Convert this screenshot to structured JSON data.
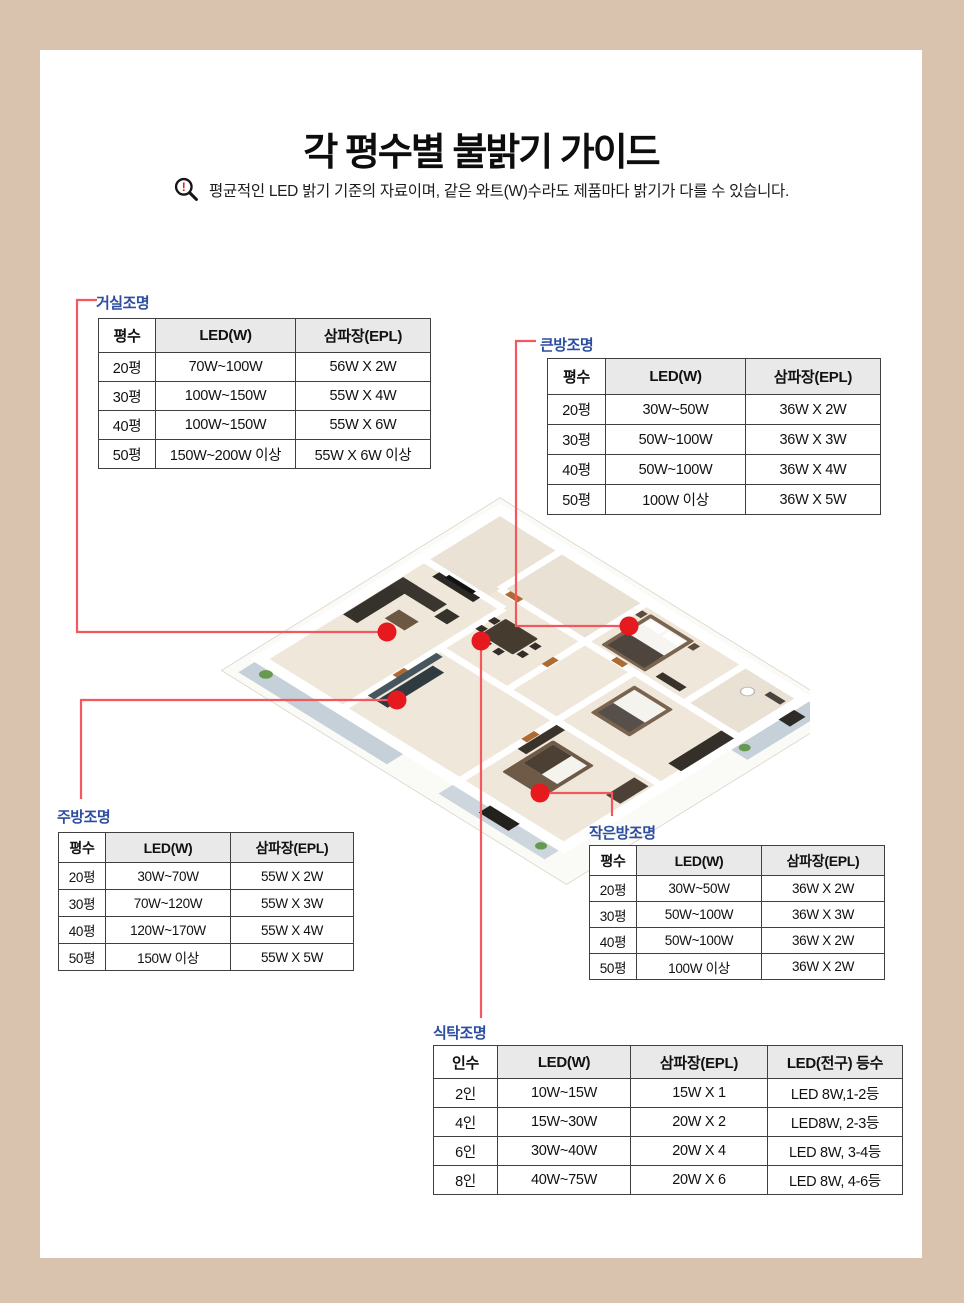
{
  "header": {
    "title": "각 평수별 불밝기 가이드",
    "notice": "평균적인 LED 밝기 기준의 자료이며, 같은 와트(W)수라도 제품마다 밝기가 다를 수 있습니다."
  },
  "colors": {
    "frame_beige": "#d9c3ae",
    "label_blue": "#2c4da0",
    "connector_red": "#f2595e",
    "dot_red": "#e6191f",
    "table_header_gray": "#e9e9e9"
  },
  "icons": {
    "notice_icon": "magnifier-exclamation-icon"
  },
  "tables": {
    "living": {
      "label": "거실조명",
      "headers": [
        "평수",
        "LED(W)",
        "삼파장(EPL)"
      ],
      "rows": [
        [
          "20평",
          "70W~100W",
          "56W X 2W"
        ],
        [
          "30평",
          "100W~150W",
          "55W X 4W"
        ],
        [
          "40평",
          "100W~150W",
          "55W X 6W"
        ],
        [
          "50평",
          "150W~200W 이상",
          "55W X 6W 이상"
        ]
      ]
    },
    "big_room": {
      "label": "큰방조명",
      "headers": [
        "평수",
        "LED(W)",
        "삼파장(EPL)"
      ],
      "rows": [
        [
          "20평",
          "30W~50W",
          "36W X 2W"
        ],
        [
          "30평",
          "50W~100W",
          "36W X 3W"
        ],
        [
          "40평",
          "50W~100W",
          "36W X 4W"
        ],
        [
          "50평",
          "100W 이상",
          "36W X 5W"
        ]
      ]
    },
    "kitchen": {
      "label": "주방조명",
      "headers": [
        "평수",
        "LED(W)",
        "삼파장(EPL)"
      ],
      "rows": [
        [
          "20평",
          "30W~70W",
          "55W X 2W"
        ],
        [
          "30평",
          "70W~120W",
          "55W X 3W"
        ],
        [
          "40평",
          "120W~170W",
          "55W X 4W"
        ],
        [
          "50평",
          "150W 이상",
          "55W X 5W"
        ]
      ]
    },
    "small_room": {
      "label": "작은방조명",
      "headers": [
        "평수",
        "LED(W)",
        "삼파장(EPL)"
      ],
      "rows": [
        [
          "20평",
          "30W~50W",
          "36W X 2W"
        ],
        [
          "30평",
          "50W~100W",
          "36W X 3W"
        ],
        [
          "40평",
          "50W~100W",
          "36W X 2W"
        ],
        [
          "50평",
          "100W 이상",
          "36W X 2W"
        ]
      ]
    },
    "dining": {
      "label": "식탁조명",
      "headers": [
        "인수",
        "LED(W)",
        "삼파장(EPL)",
        "LED(전구) 등수"
      ],
      "rows": [
        [
          "2인",
          "10W~15W",
          "15W X 1",
          "LED 8W,1-2등"
        ],
        [
          "4인",
          "15W~30W",
          "20W X 2",
          "LED8W, 2-3등"
        ],
        [
          "6인",
          "30W~40W",
          "20W X 4",
          "LED 8W, 3-4등"
        ],
        [
          "8인",
          "40W~75W",
          "20W X 6",
          "LED 8W, 4-6등"
        ]
      ]
    }
  }
}
